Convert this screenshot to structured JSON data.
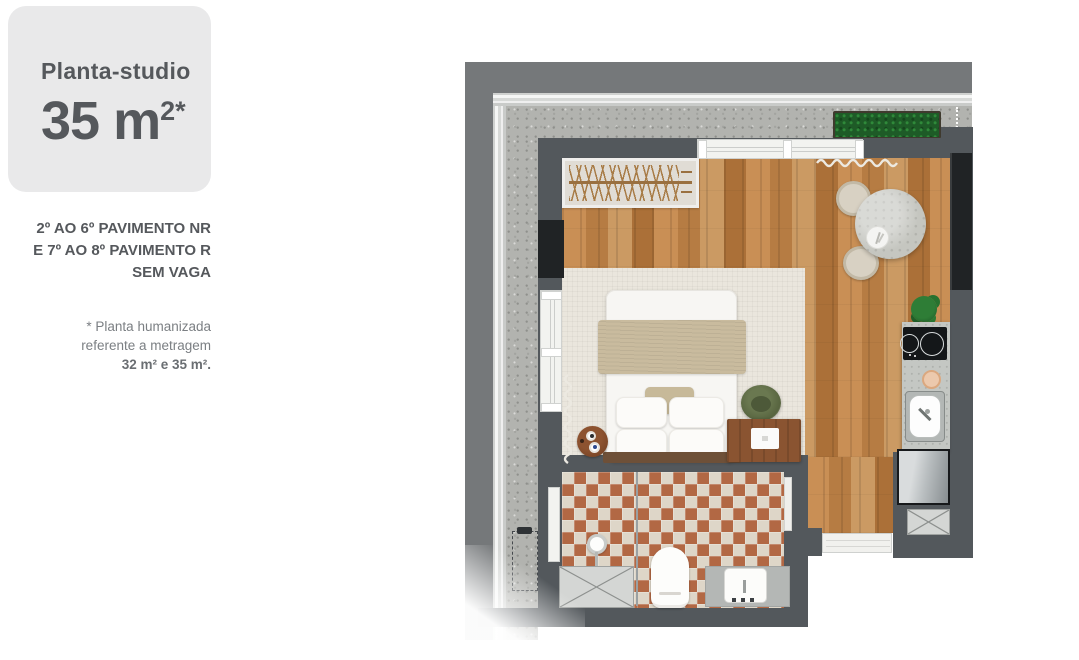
{
  "theme": {
    "card-bg": "#e9e9ea",
    "ink": "#55585c",
    "ink-soft": "#7b7f83",
    "facade": "#75787a",
    "wall": "#53585c",
    "panel-dark": "#202325",
    "concrete": "#b2b3af",
    "molding": "#d9dbd9",
    "wood": "#bd8a52",
    "wood-dark": "#b67c43",
    "wood-light": "#cb9a63",
    "rug": "#eae6dd",
    "tile-a": "#b26844",
    "tile-b": "#ded6c8",
    "planter": "#1e5b27",
    "counter": "#c4c7c3",
    "steel-light": "#d9dcdd",
    "steel-dark": "#878d90",
    "shaft-bg": "#d4d6d4",
    "shaft-line": "#8d908e",
    "blanket": "#c9bb9e",
    "olive": "#57643f",
    "desk-wood": "#8a5431",
    "chair-beige": "#d8d1c3",
    "table-top": "#c5c6c0"
  },
  "info_panel": {
    "card": {
      "title": "Planta-studio",
      "area_main": "35 m",
      "area_sup": "2*"
    },
    "floors_lines": [
      "2º AO 6º PAVIMENTO NR",
      "E 7º AO 8º PAVIMENTO R",
      "SEM VAGA"
    ],
    "disclaimer_lines": [
      "* Planta humanizada",
      "referente a metragem",
      "32 m² e 35 m²."
    ]
  },
  "plan": {
    "elements": [
      "wardrobe",
      "top-window",
      "balcony-planter",
      "curtain",
      "dining-table",
      "dining-chairs",
      "plate",
      "kitchen-plant",
      "cooktop",
      "kitchen-counter",
      "bowl",
      "kitchen-sink",
      "fridge",
      "utility-shaft",
      "double-bed",
      "blanket",
      "pillows",
      "rug",
      "side-table",
      "desk",
      "desk-chair",
      "tv-panel",
      "left-window",
      "shower",
      "shower-window",
      "glass-partition",
      "toilet",
      "vanity-sink",
      "bathroom-shaft",
      "entry-door",
      "bathroom-door",
      "ac-unit-outline"
    ]
  }
}
